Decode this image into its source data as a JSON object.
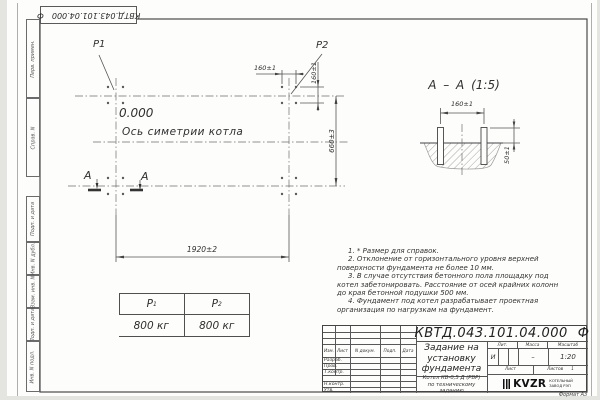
{
  "stamp_box": {
    "number": "КВТД.043.101.04.000",
    "suffix": "Ф"
  },
  "margin_labels": [
    "Перв. примен.",
    "Справ. N",
    "Подп. и дата",
    "Инв. N дубл.",
    "Взам. инв. N",
    "Подп. и дата",
    "Инв. N подл."
  ],
  "plan": {
    "p1": "P1",
    "p2": "P2",
    "elevation": "0.000",
    "axis": "Ось симетрии котла",
    "dim_width": "1920±2",
    "dim_depth": "660±3",
    "dim_pitch_x": "160±1",
    "dim_pitch_y": "160±1",
    "section_mark_left": "А",
    "section_mark_right": "А"
  },
  "section": {
    "title": "А – А (1:5)",
    "dim_pitch": "160±1",
    "dim_height": "50±1"
  },
  "loads": {
    "col1_sym": "Р",
    "col1_sub": "1",
    "col2_sym": "Р",
    "col2_sub": "2",
    "val1": "800 кг",
    "val2": "800 кг"
  },
  "notes": [
    "1. * Размер для справок.",
    "2. Отклонение от горизонтального уровня верхней поверхности фундамента не более 10 мм.",
    "3. В случае отсутствия бетонного пола площадку под котел забетонировать. Расстояние от осей крайних колонн до края бетонной подушки 500 мм.",
    "4. Фундамент под котел разрабатывает проектная организация по нагрузкам на фундамент."
  ],
  "title_block": {
    "doc_number": "КВТД.043.101.04.000",
    "doc_suffix": "Ф",
    "title_line1": "Задание на",
    "title_line2": "установку",
    "title_line3": "фундамента",
    "product_line1": "Котел  КВ-0,5  Д  (РВР)",
    "product_line2": "по техническому заданию",
    "col_izm": "Изм.",
    "col_list": "Лист",
    "col_doc": "N докум.",
    "col_sign": "Подп.",
    "col_date": "Дата",
    "roles": [
      "Разраб.",
      "Пров.",
      "Т.контр.",
      "",
      "Н.контр.",
      "Утв."
    ],
    "lit_label": "Лит.",
    "mass_label": "Масса",
    "scale_label": "Масштаб",
    "lit_value": "И",
    "mass_value": "–",
    "scale_value": "1:20",
    "sheet_label": "Лист",
    "sheets_label": "Листов",
    "sheets_value": "1",
    "company_logo": "KVZR",
    "company_line1": "КОТЕЛЬНЫЙ",
    "company_line2": "ЗАВОД РЭП",
    "format_label": "Формат А3"
  }
}
